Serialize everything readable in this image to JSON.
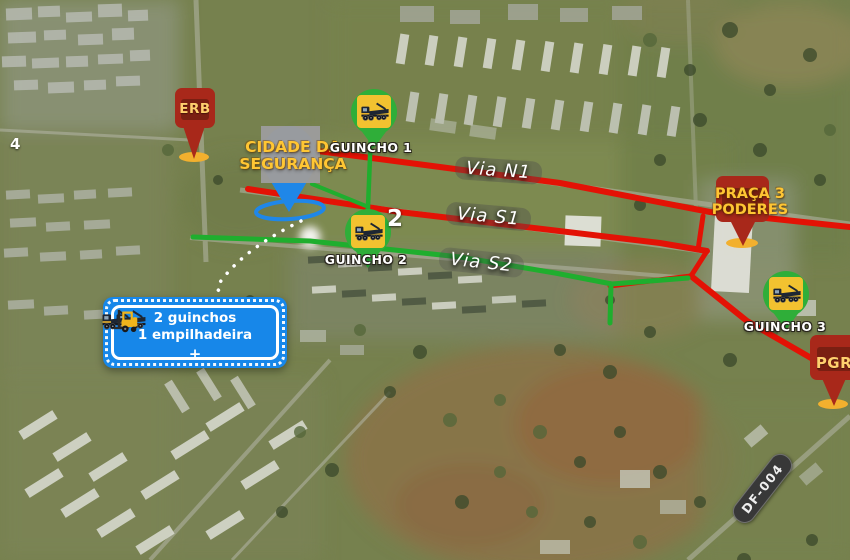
{
  "map": {
    "markers": {
      "erb": {
        "label": "ERB"
      },
      "cidade_seguranca": {
        "line1": "CIDADE DA",
        "line2": "SEGURANÇA"
      },
      "praca_tres_poderes": {
        "line1": "PRAÇA 3",
        "line2": "PODERES"
      },
      "pgr": {
        "label": "PGR"
      }
    },
    "tow_trucks": [
      {
        "label": "GUINCHO 1",
        "badge": ""
      },
      {
        "label": "GUINCHO 2",
        "badge": "2"
      },
      {
        "label": "GUINCHO 3",
        "badge": ""
      }
    ],
    "road_labels": {
      "via_n1": "Via N1",
      "via_s1": "Via S1",
      "via_s2": "Via S2",
      "df_004": "DF-004",
      "partial_road_number": "4"
    },
    "callout": {
      "line1": "2 guinchos",
      "line2": "1 empilhadeira",
      "plus_sign": "+"
    },
    "icons": {
      "tow_truck": "tow-truck-icon",
      "forklift": "forklift-icon",
      "location_pin": "location-pin-icon",
      "coverage_ellipse": "coverage-ellipse-icon"
    },
    "colors": {
      "route_red": "#e31205",
      "route_green": "#1fae2e",
      "marker_dark_red": "#a8281a",
      "marker_inner_red": "#7a1f12",
      "marker_text_yellow": "#ffc633",
      "pin_blue": "#1f87e8",
      "callout_blue": "#1787e9",
      "guincho_green": "#2fae39",
      "guincho_yellow": "#f2c230"
    }
  }
}
